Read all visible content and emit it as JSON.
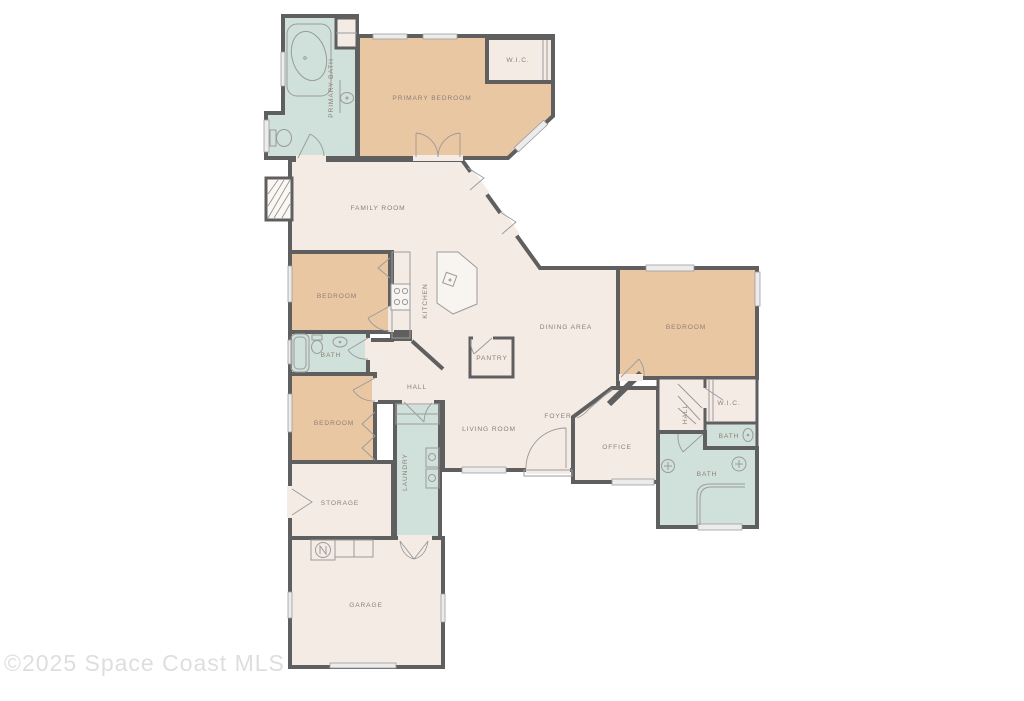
{
  "watermark": "©2025 Space Coast MLS",
  "colors": {
    "background": "#ffffff",
    "wall": "#5f5f5f",
    "bedroom_fill": "#eac7a3",
    "bath_fill": "#d0e0da",
    "common_fill": "#f4ebe4",
    "label_text": "#8d8177",
    "watermark_text": "#dedede",
    "fixture_line": "#9b9b9b"
  },
  "rooms": {
    "primary_bath": "PRIMARY BATH",
    "wic_primary": "W.I.C.",
    "primary_bedroom": "PRIMARY BEDROOM",
    "family_room": "FAMILY ROOM",
    "bedroom_left_upper": "BEDROOM",
    "kitchen": "KITCHEN",
    "dining_area": "DINING AREA",
    "bedroom_right": "BEDROOM",
    "bath_left": "BATH",
    "hall_center": "HALL",
    "pantry": "PANTRY",
    "bedroom_left_lower": "BEDROOM",
    "laundry": "LAUNDRY",
    "living_room": "LIVING ROOM",
    "foyer": "FOYER",
    "office": "OFFICE",
    "hall_right": "HALL",
    "wic_right": "W.I.C.",
    "bath_right_upper": "BATH",
    "bath_right_lower": "BATH",
    "storage": "STORAGE",
    "garage": "GARAGE"
  }
}
